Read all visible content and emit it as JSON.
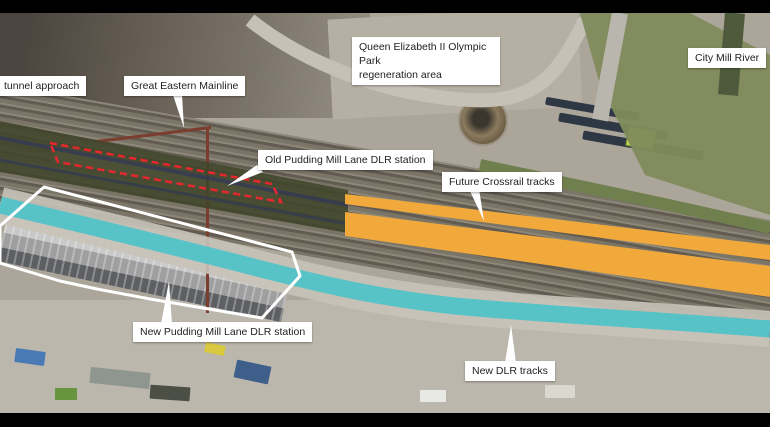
{
  "labels": {
    "tunnel_approach": "tunnel approach",
    "great_eastern_mainline": "Great Eastern Mainline",
    "olympic_park_line1": "Queen Elizabeth II Olympic Park",
    "olympic_park_line2": "regeneration area",
    "city_mill_river": "City Mill River",
    "old_station": "Old Pudding Mill Lane DLR station",
    "future_crossrail": "Future Crossrail tracks",
    "new_station": "New Pudding Mill Lane DLR station",
    "new_dlr_tracks": "New DLR tracks"
  },
  "colors": {
    "crossrail_orange": "#F2A93C",
    "dlr_teal": "#4FC3C8",
    "tunnel_olive": "#40462A",
    "old_station_red": "#E8262D",
    "outline_white": "#FFFFFF",
    "label_bg": "#FFFFFF",
    "label_text": "#222222"
  }
}
